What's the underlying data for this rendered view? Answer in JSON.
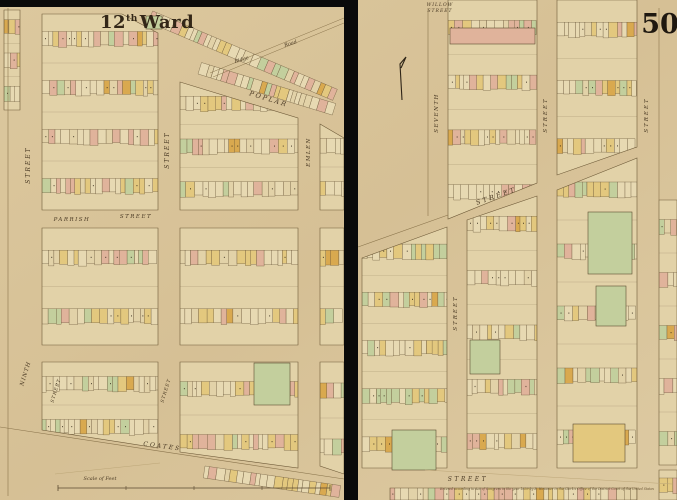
{
  "header": {
    "ward_number": "12",
    "ward_suffix": "th",
    "ward_word": "Ward",
    "plate_number": "50"
  },
  "colors": {
    "paper": "#d8c49b",
    "paper_light": "#e2d2a8",
    "lot_cream": "#e7d9b2",
    "lot_yellow": "#e3c87e",
    "lot_pink": "#e0b39b",
    "lot_green": "#c3cf9d",
    "lot_orange": "#d9a94f",
    "ink": "#6b583a",
    "ink_dark": "#2e2417",
    "seam_black": "#0a0a0a",
    "label_ink": "#4a3a24"
  },
  "labels": [
    "Ridge",
    "Road",
    "POPLAR",
    "STREET",
    "PARRISH",
    "STREET",
    "STREET",
    "EMLEN",
    "NINTH",
    "STREET",
    "STREET",
    "COATES",
    "Scale of Feet",
    "WILLOW",
    "STREET",
    "SEVENTH",
    "STREET",
    "STREET",
    "STREET",
    "STREET",
    "STREET",
    "Entered according to Act of Congress in the year 1859 by E. Hexamer in the Clerk's Office of the District Court of the United States"
  ]
}
